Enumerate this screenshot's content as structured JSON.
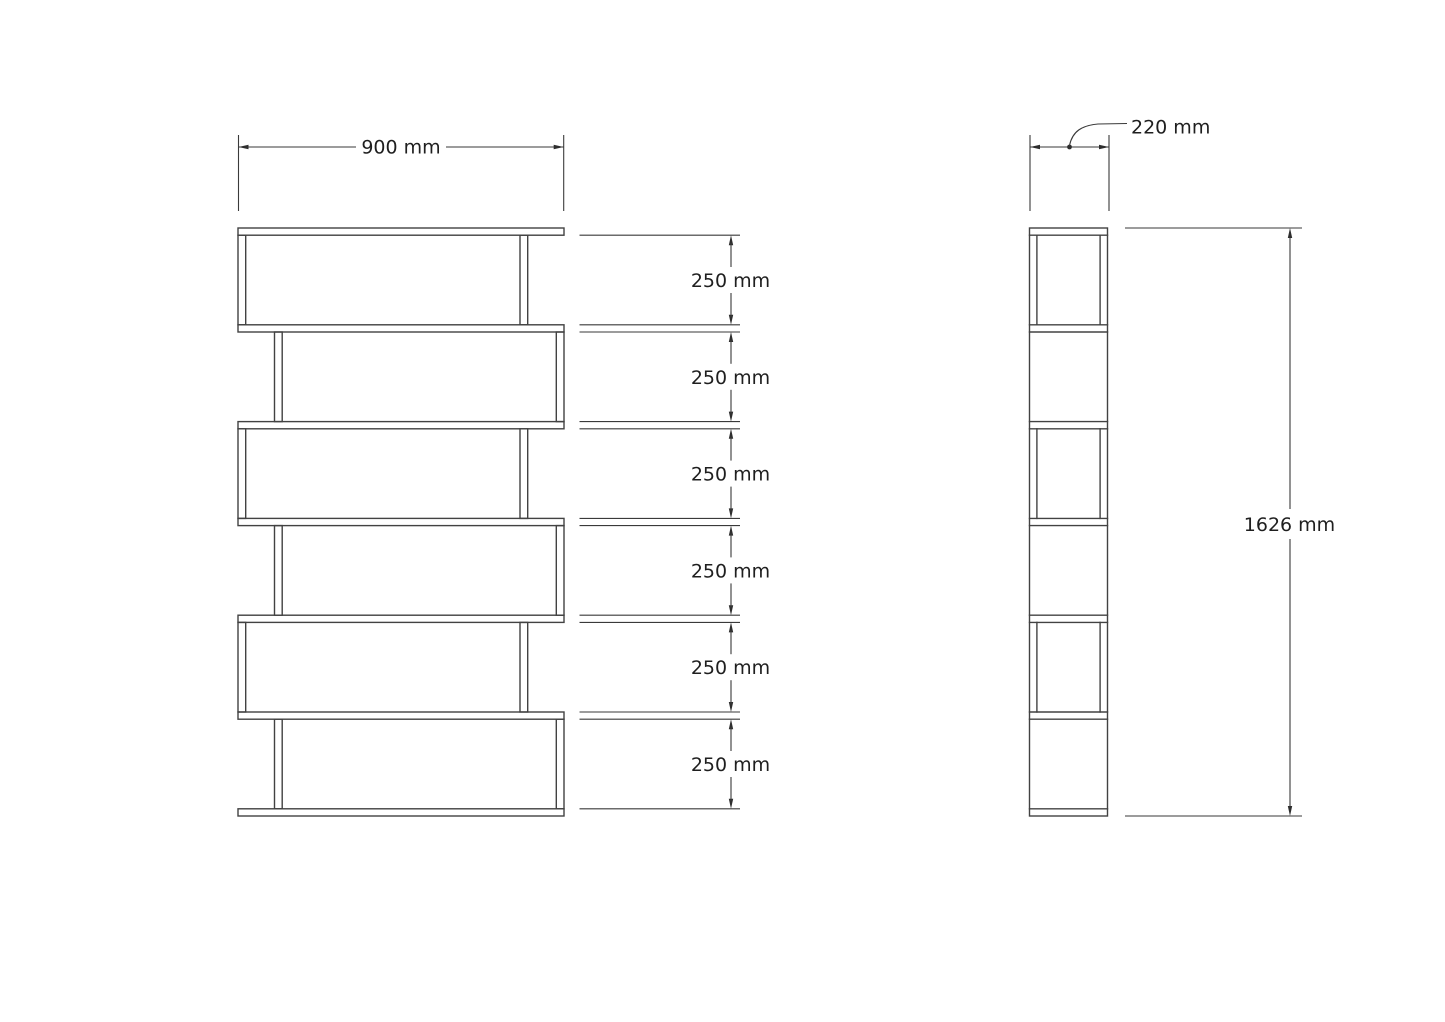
{
  "drawing": {
    "type": "furniture-dimension-diagram",
    "background": "#ffffff",
    "colors": {
      "line": "#424242",
      "dimension_line": "#3a3a3a",
      "text": "#1f1f1f"
    },
    "front_view": {
      "width_dim": {
        "label": "900 mm",
        "value_mm": 900
      },
      "shelf_sections": 6,
      "section_labels": [
        "250 mm",
        "250 mm",
        "250 mm",
        "250 mm",
        "250 mm",
        "250 mm"
      ],
      "section_value_mm": 250
    },
    "side_view": {
      "depth_dim": {
        "label": "220 mm",
        "value_mm": 220
      },
      "height_dim": {
        "label": "1626 mm",
        "value_mm": 1626
      }
    }
  }
}
